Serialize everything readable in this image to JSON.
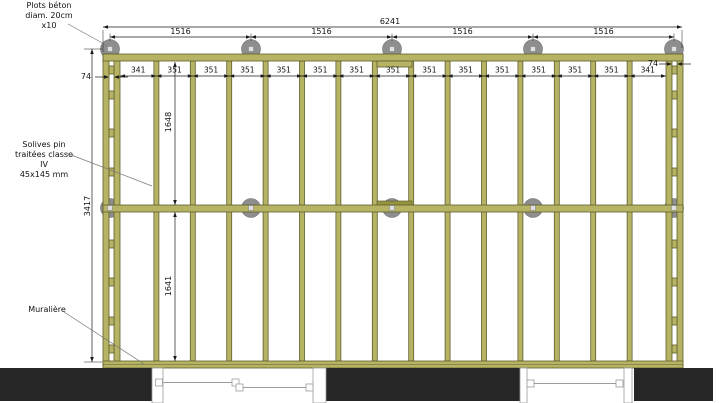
{
  "drawing": {
    "callouts": {
      "plots": {
        "line1": "Plots béton",
        "line2": "diam. 20cm",
        "line3": "x10"
      },
      "solives": {
        "line1": "Solives pin",
        "line2": "traitées classe IV",
        "line3": "45x145 mm"
      },
      "muraliere": {
        "line1": "Muralière"
      }
    },
    "dimensions": {
      "overall_width": "6241",
      "plot_spacing": [
        "1516",
        "1516",
        "1516",
        "1516"
      ],
      "rim_gap_left": "74",
      "rim_gap_right": "74",
      "joist_bays": [
        "341",
        "351",
        "351",
        "351",
        "351",
        "351",
        "351",
        "351",
        "351",
        "351",
        "351",
        "351",
        "351",
        "351",
        "341"
      ],
      "overall_depth": "3417",
      "upper_span": "1648",
      "lower_span": "1641"
    },
    "counts": {
      "plot_pads": 10
    },
    "colors": {
      "wood": "#b6b364",
      "wood_edge": "#5e5e2d",
      "splice": "#97943f",
      "plot_pad": "#8e8e8e",
      "wall": "#262626",
      "dim": "#1a1a1a",
      "opening": "#9c9c9c"
    }
  }
}
